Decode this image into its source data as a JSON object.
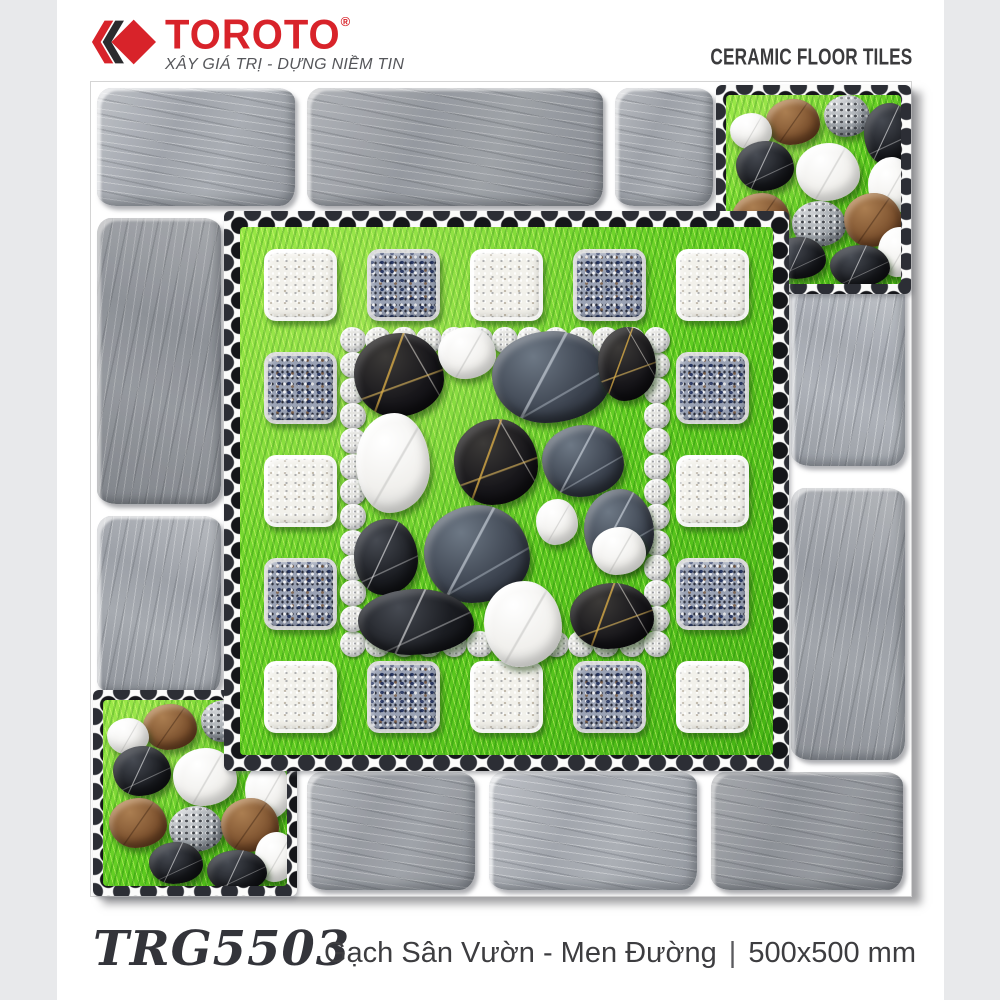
{
  "header": {
    "brand": "TOROTO",
    "registered": "®",
    "tagline": "XÂY GIÁ TRỊ - DỰNG NIỀM TIN",
    "product_type": "CERAMIC FLOOR TILES"
  },
  "tile_photo": {
    "alt": "Garden ceramic tile: grey slate brick border, green grass, terrazzo and granite blocks, black, white and brown pebbles",
    "elements": {
      "border_bricks": "grey slate bricks",
      "corner_patches": "grass with white, black, brown and grey pebbles",
      "block_ring": "alternating white terrazzo and blue granite square blocks on grass",
      "pebble_chain": "square chain of small grey speckled pebbles",
      "center_field": "black marble, dark slate and white pebbles on grass",
      "pebble_band": "black pebble edging band"
    }
  },
  "footer": {
    "product_code": "TRG5503",
    "description": "Gạch Sân Vườn - Men Đường",
    "separator": "|",
    "size": "500x500 mm"
  },
  "colors": {
    "brand_red": "#d8232a",
    "chevron_dark": "#2b2b2e",
    "text_dark": "#3b3b3d",
    "gutter_grey": "#e8e9eb",
    "grass_green": "#5ecb20",
    "brick_grey": "#9da1a8"
  }
}
